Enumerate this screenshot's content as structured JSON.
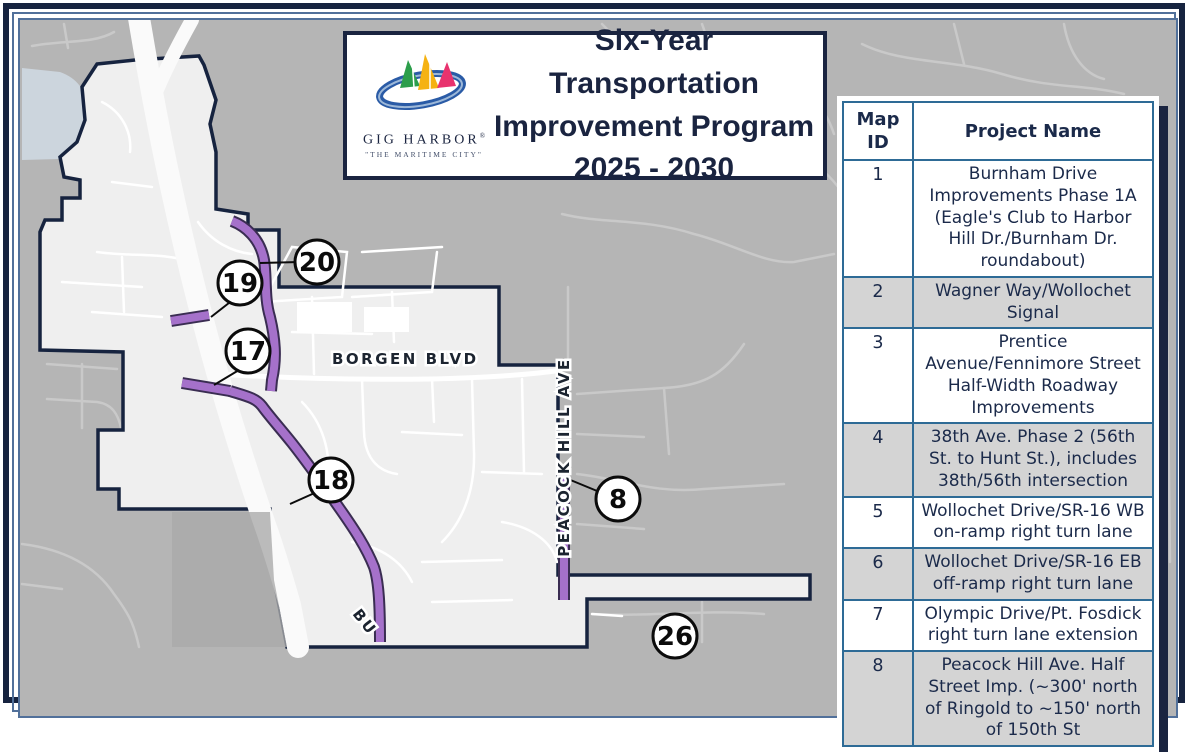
{
  "title_box": {
    "line1": "Six-Year Transportation",
    "line2": "Improvement Program",
    "line3": "2025 - 2030",
    "logo": {
      "name": "GIG HARBOR",
      "registered": "®",
      "tagline": "\"THE MARITIME CITY\""
    }
  },
  "table": {
    "headers": [
      "Map ID",
      "Project Name"
    ],
    "rows": [
      {
        "id": "1",
        "name": "Burnham Drive Improvements Phase 1A (Eagle's Club to Harbor Hill Dr./Burnham Dr. roundabout)"
      },
      {
        "id": "2",
        "name": "Wagner Way/Wollochet Signal"
      },
      {
        "id": "3",
        "name": "Prentice Avenue/Fennimore Street Half-Width Roadway Improvements"
      },
      {
        "id": "4",
        "name": "38th Ave. Phase 2 (56th St. to Hunt St.), includes 38th/56th intersection"
      },
      {
        "id": "5",
        "name": "Wollochet Drive/SR-16 WB on-ramp right turn lane"
      },
      {
        "id": "6",
        "name": "Wollochet Drive/SR-16 EB off-ramp right turn lane"
      },
      {
        "id": "7",
        "name": "Olympic Drive/Pt. Fosdick right turn lane extension"
      },
      {
        "id": "8",
        "name": "Peacock Hill Ave. Half Street Imp. (~300' north of Ringold to ~150' north of 150th St"
      }
    ]
  },
  "map": {
    "street_labels": {
      "borgen": "BORGEN BLVD",
      "peacock": "PEACOCK HILL AVE",
      "burnham_partial": "BU"
    },
    "markers": [
      {
        "label": "19"
      },
      {
        "label": "20"
      },
      {
        "label": "17"
      },
      {
        "label": "18"
      },
      {
        "label": "8"
      },
      {
        "label": "26"
      }
    ]
  },
  "colors": {
    "navy": "#1a2440",
    "table_grid_blue": "#2e6b96",
    "project_purple": "#a571ca",
    "city_fill": "#efefef",
    "outside_fill": "#b5b5b5",
    "water": "#ccd5dd",
    "shaded_row": "#d4d4d4"
  }
}
